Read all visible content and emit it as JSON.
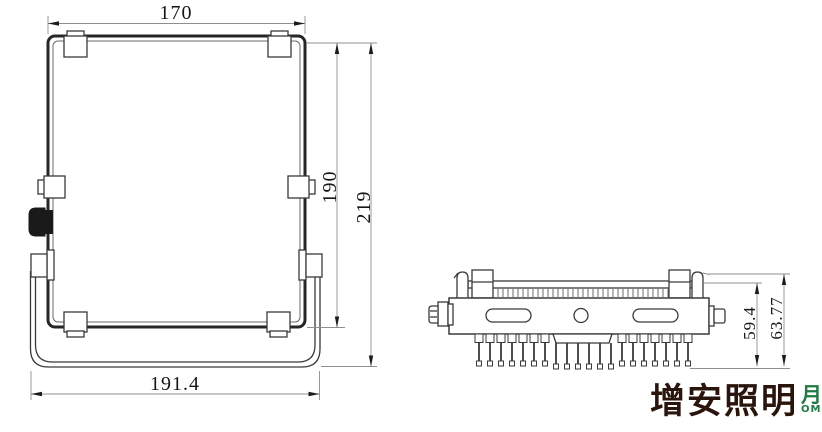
{
  "dims": {
    "front_width_top": "170",
    "front_height_frame": "190",
    "front_height_total": "219",
    "front_width_bottom": "191.4",
    "side_height_body": "59.4",
    "side_height_total": "63.77"
  },
  "logo": {
    "text": "增安照明",
    "clipped_glyph": "月",
    "clipped_suffix": "OM"
  },
  "colors": {
    "drawing_line": "#3a3a3a",
    "frame_line": "#262626",
    "dimension_line": "#8f8f8f",
    "dimension_text": "#161616",
    "gland_fill": "#1a1a1a",
    "logo_text": "#2a140b",
    "logo_accent": "#1e7a41",
    "background": "#ffffff"
  }
}
